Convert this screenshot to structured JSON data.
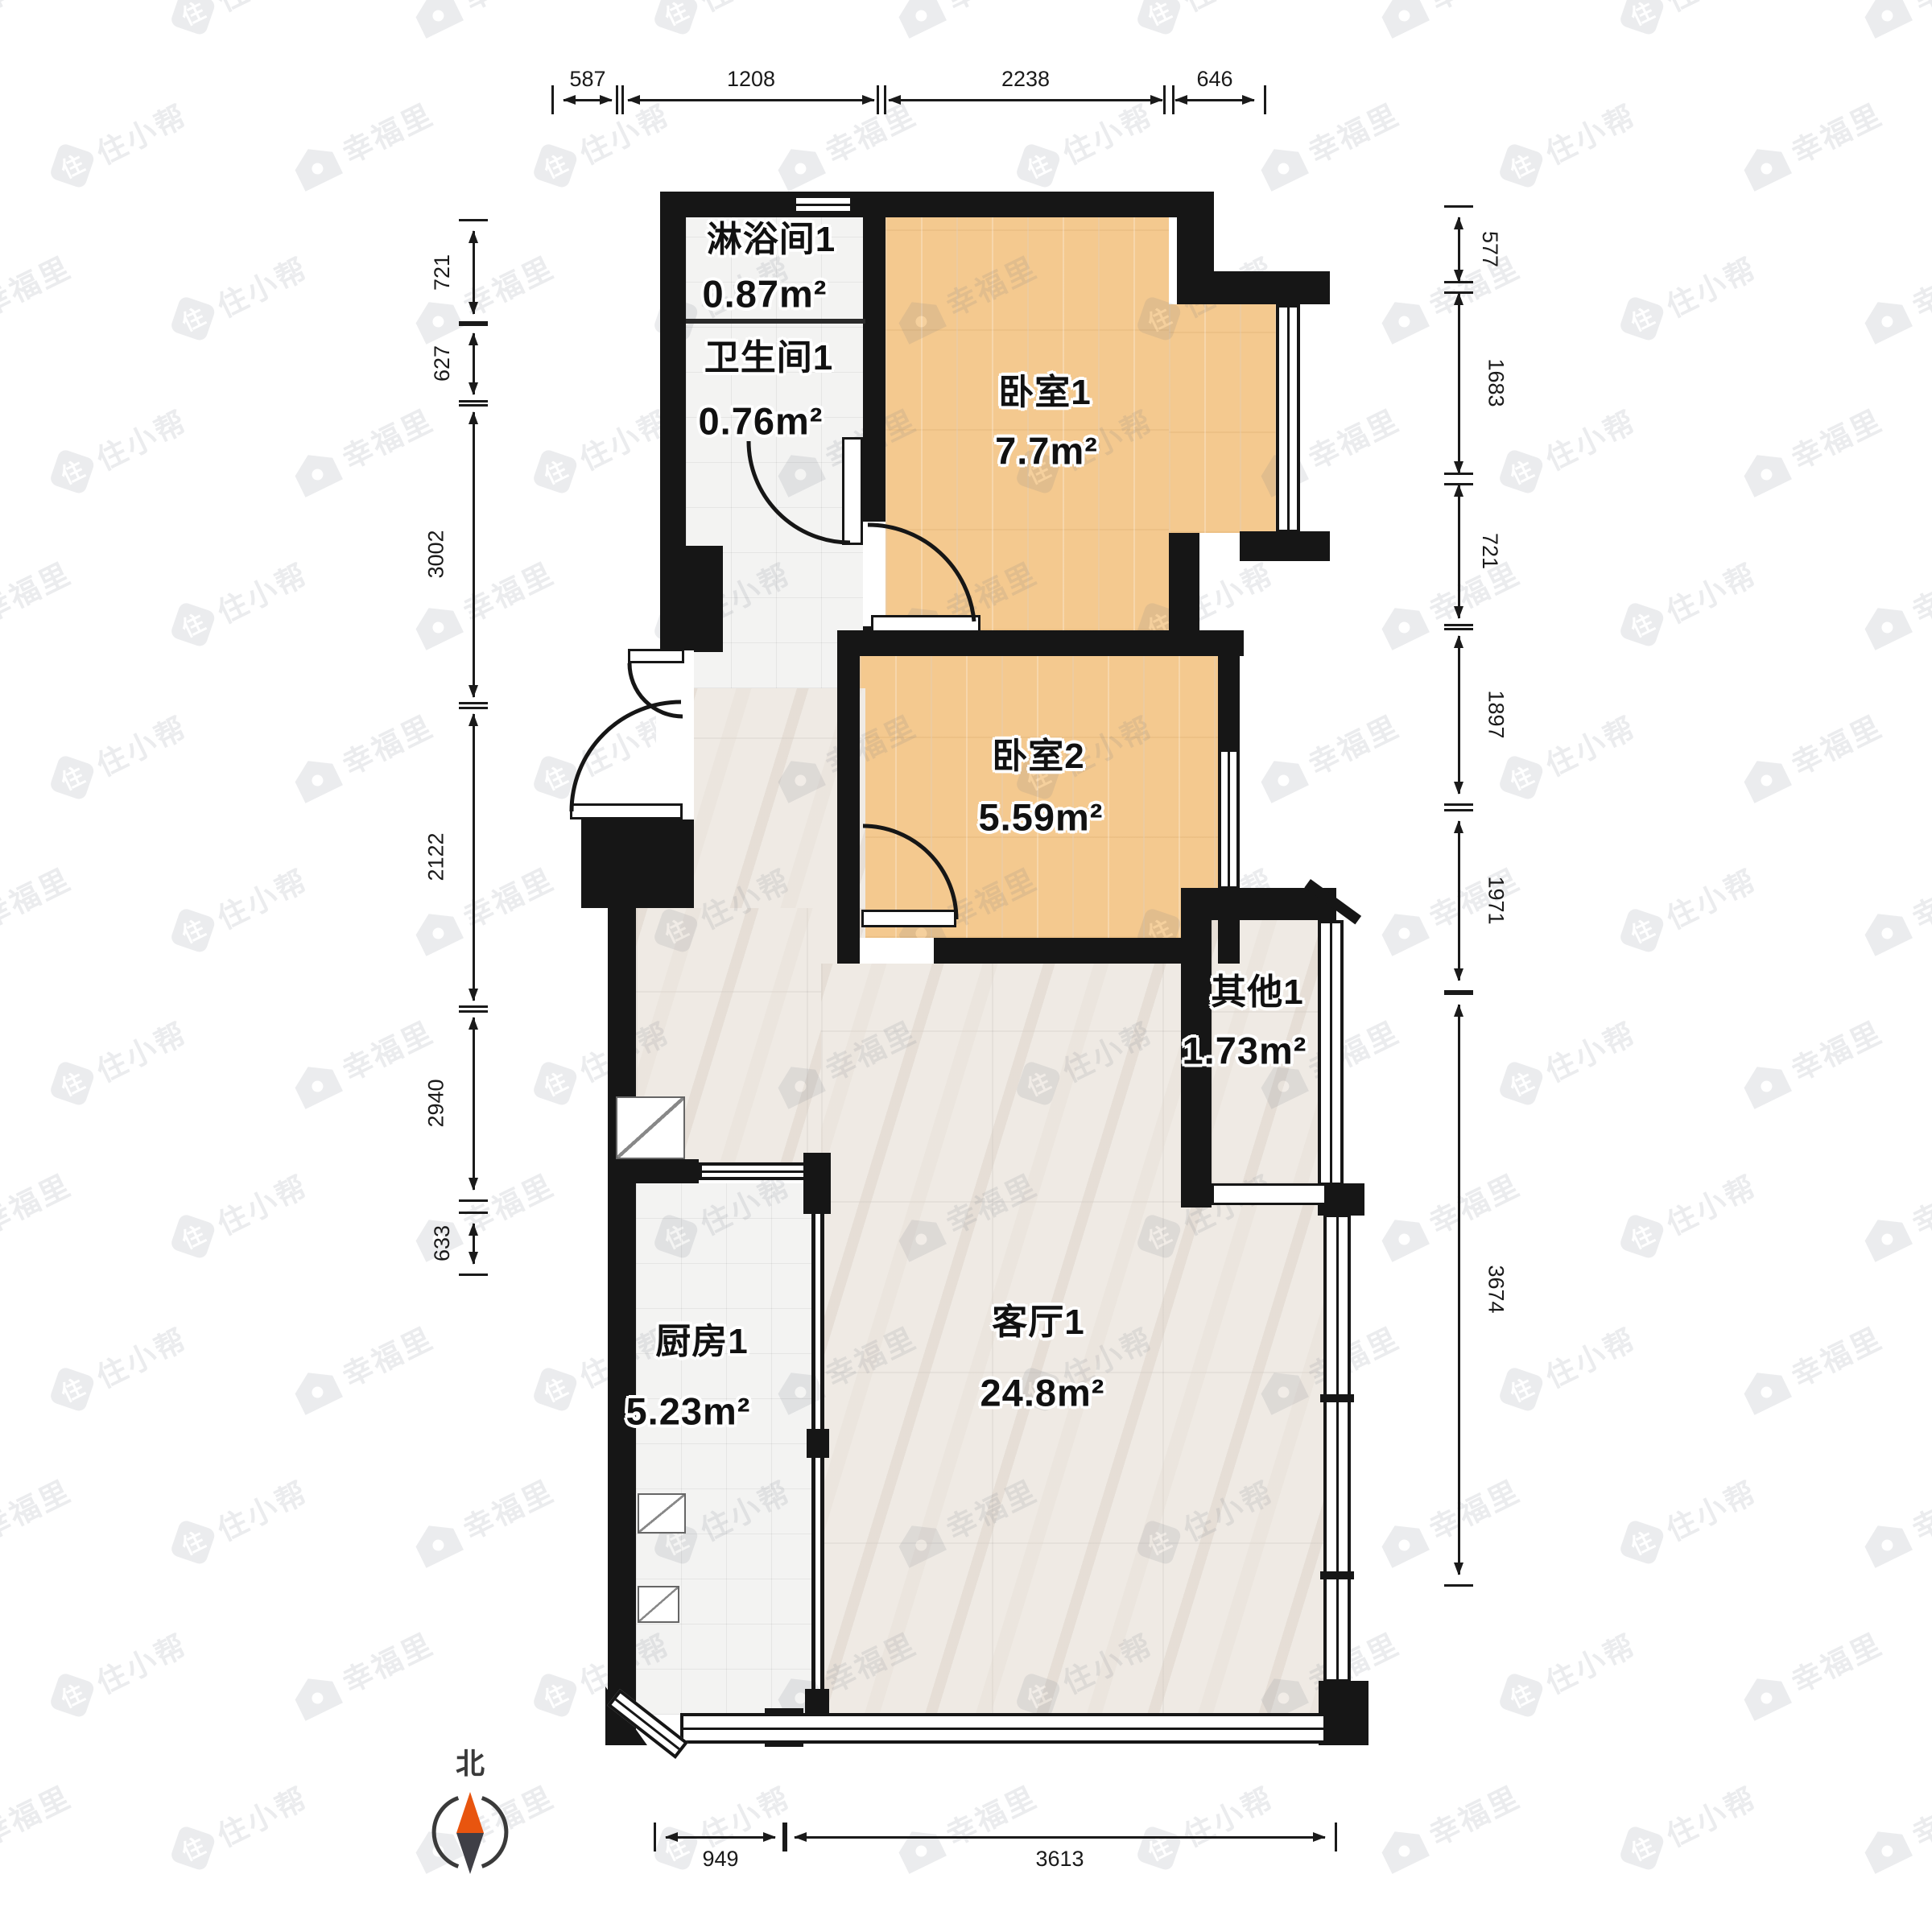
{
  "meta": {
    "type": "floor-plan",
    "compass_label": "北"
  },
  "rooms": [
    {
      "id": "shower",
      "name": "淋浴间1",
      "area": "0.87m²"
    },
    {
      "id": "toilet",
      "name": "卫生间1",
      "area": "0.76m²"
    },
    {
      "id": "bedroom1",
      "name": "卧室1",
      "area": "7.7m²"
    },
    {
      "id": "bedroom2",
      "name": "卧室2",
      "area": "5.59m²"
    },
    {
      "id": "other",
      "name": "其他1",
      "area": "1.73m²"
    },
    {
      "id": "kitchen",
      "name": "厨房1",
      "area": "5.23m²"
    },
    {
      "id": "living",
      "name": "客厅1",
      "area": "24.8m²"
    }
  ],
  "dimensions": {
    "top": [
      "587",
      "1208",
      "2238",
      "646"
    ],
    "left": [
      "721",
      "627",
      "3002",
      "2122",
      "2940",
      "633"
    ],
    "right": [
      "577",
      "1683",
      "721",
      "1897",
      "1971",
      "3674"
    ],
    "bottom": [
      "949",
      "3613"
    ]
  },
  "watermarks": {
    "brand_a": "幸福里",
    "brand_b": "住小帮",
    "logo_char": "住"
  },
  "colors": {
    "wall": "#161616",
    "wood_floor": "#f4c98f",
    "tile_floor": "#f3f3f2",
    "marble_floor": "#efeae4",
    "compass_north": "#e8550f",
    "compass_south": "#3f3f46",
    "dim_text": "#1a1a1a"
  }
}
